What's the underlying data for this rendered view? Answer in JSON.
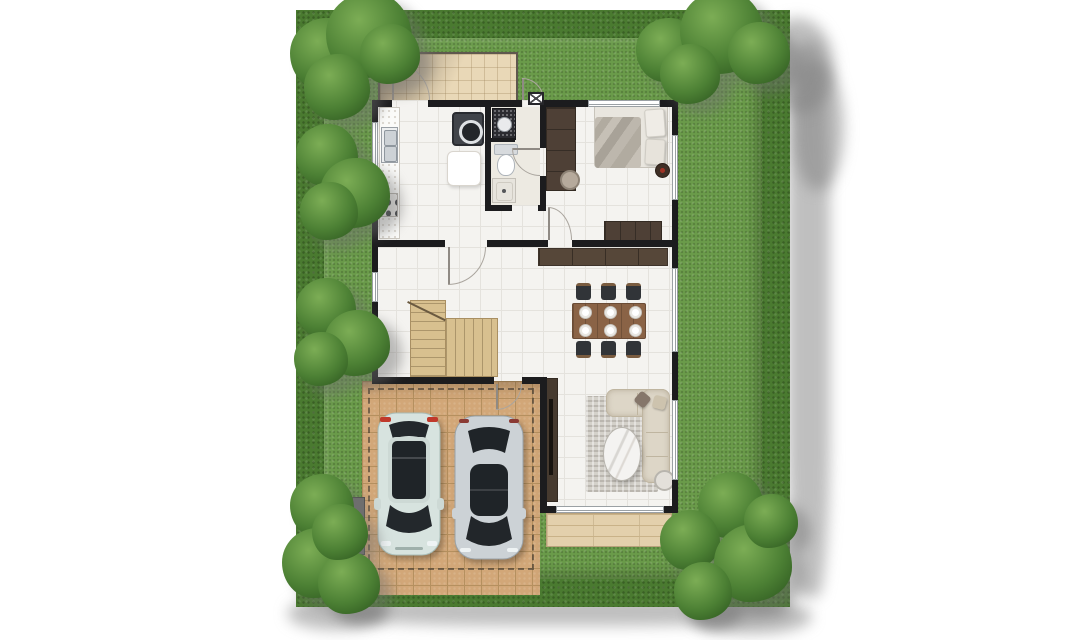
{
  "scene": {
    "type": "residential-floor-plan-top-view",
    "rooms": [
      "kitchen",
      "bathroom",
      "bedroom",
      "hallway",
      "staircase",
      "dining-area",
      "living-room"
    ],
    "outdoor_areas": [
      "hedge-border",
      "lawn",
      "service-yard",
      "carport",
      "driveway",
      "terrace"
    ],
    "trees": 6,
    "kitchen": [
      "counter-with-sink",
      "cooktop",
      "washing-machine",
      "prep-table"
    ],
    "bathroom": [
      "vanity-counter",
      "toilet",
      "shower"
    ],
    "bedroom": [
      "double-bed",
      "pillows",
      "wardrobe",
      "desk-chair",
      "dresser",
      "bedside-stool"
    ],
    "dining": {
      "tables": 1,
      "chairs": 6,
      "place_settings": 6,
      "sideboards": 1
    },
    "living": [
      "l-shaped-sofa",
      "throw-pillows",
      "area-rug",
      "oval-marble-coffee-table",
      "round-side-table",
      "tv-cabinet"
    ],
    "equipment": [
      "ac-condenser-unit",
      "meter-box",
      "gate-pillar"
    ],
    "vehicles": [
      {
        "kind": "suv",
        "body_color": "#d7e3df",
        "glass_color": "#22262b",
        "taillight_color": "#c0392b"
      },
      {
        "kind": "sedan",
        "body_color": "#ccd2d6",
        "glass_color": "#22262b"
      }
    ]
  },
  "palette": {
    "grass": "#6a9b4a",
    "hedge": "#4a7a30",
    "treeLight": "#7cad55",
    "treeMid": "#4c8034",
    "treeDark": "#2f5a20",
    "wall": "#1c1c1e",
    "floor": "#f4f3f0",
    "floorLine": "#e4e2dd",
    "bathFloor": "#edeae2",
    "serviceTile": "#e9d8b7",
    "carportTile": "#d2a778",
    "carportLine": "#b5905f",
    "stairWood": "#d8c08f",
    "terraceWood": "#e3d0ac",
    "terraceLine": "#c9b288",
    "darkWood": "#4e4036",
    "sideboardWood": "#564739",
    "tableWood": "#8a6346",
    "chairSeat": "#313438",
    "chairWood": "#7a5c40",
    "sofaFabric": "#ddd6c7",
    "rug": "#d4d1ca",
    "counterMarble": "#fbfbf9",
    "steel": "#cdd2d6",
    "applianceDark": "#41444a",
    "suvBody": "#d7e3df",
    "sedanBody": "#ccd2d6",
    "carGlass": "#22262b",
    "tailRed": "#c0392b",
    "dropShadow": "rgba(128,128,128,0.5)"
  }
}
